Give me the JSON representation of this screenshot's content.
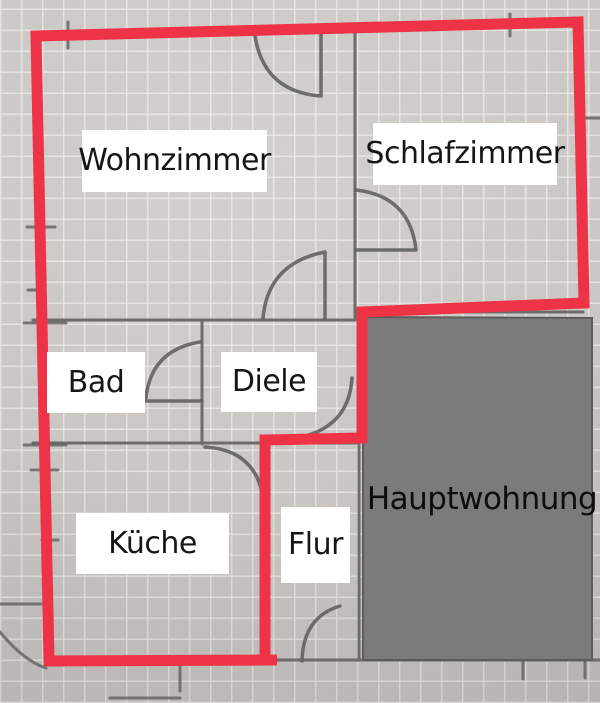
{
  "floorplan": {
    "rooms": {
      "wohnzimmer": "Wohnzimmer",
      "schlafzimmer": "Schlafzimmer",
      "bad": "Bad",
      "diele": "Diele",
      "kueche": "Küche",
      "flur": "Flur",
      "hauptwohnung": "Hauptwohnung"
    },
    "colors": {
      "outline_red": "#ef3347",
      "hauptwohnung_gray": "#7b7b7b",
      "pencil": "#5f5f5f",
      "paper": "#c7c4c1",
      "label_bg": "#ffffff",
      "label_text": "#161616"
    }
  }
}
